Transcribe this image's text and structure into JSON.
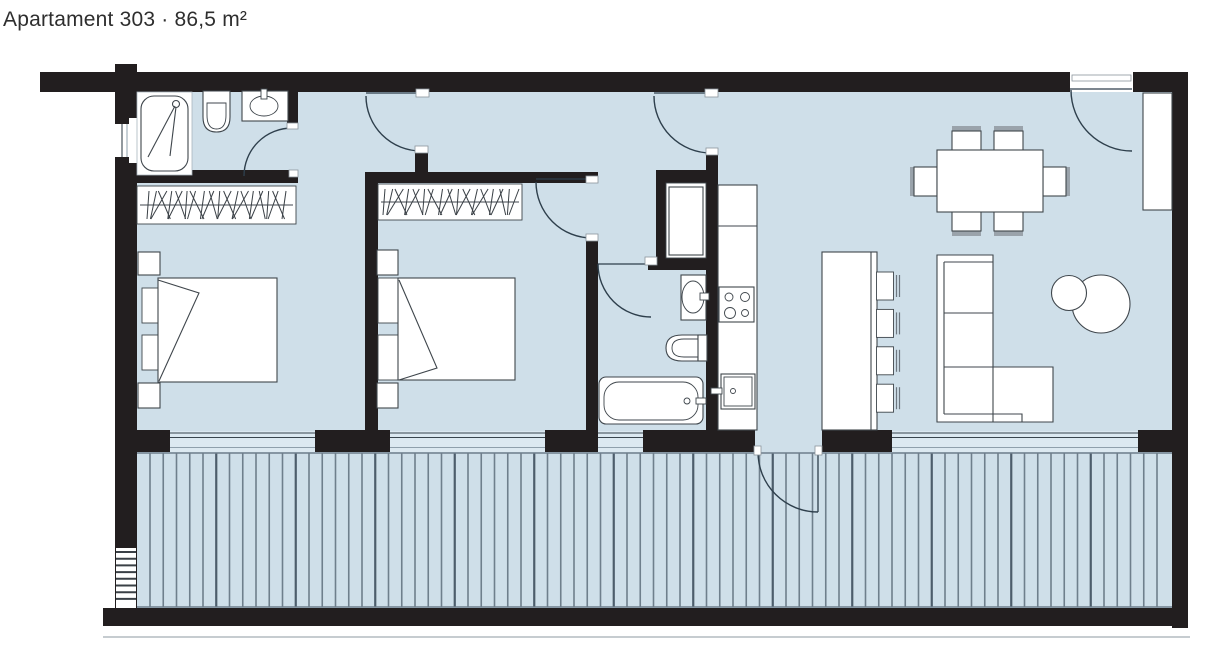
{
  "header": {
    "title": "Apartament 303 · 86,5 m²"
  },
  "plan": {
    "unit_label": "Apartament",
    "unit_number": "303",
    "separator": "·",
    "area_label": "86,5 m²",
    "colors": {
      "wall": "#221e1f",
      "floor": "#cfdfe9",
      "outline": "#3f464c",
      "arc": "#2e3f4c",
      "deck_line": "#6f7f8c",
      "deck_line_accent": "#4d5d6b",
      "chair_back": "#9aa3ab"
    },
    "symbols": [
      "shower",
      "toilet",
      "washbasin",
      "double-bed",
      "nightstand",
      "pillow",
      "wardrobe-with-hangers",
      "bathtub",
      "entry-closet",
      "kitchen-counter",
      "cooktop-4-burners",
      "kitchen-sink",
      "island-with-bar-stools",
      "dining-table-6-chairs",
      "corner-sofa",
      "round-coffee-tables",
      "tall-cabinet",
      "door-swing",
      "window",
      "terrace-decking",
      "wall-ladder"
    ]
  }
}
